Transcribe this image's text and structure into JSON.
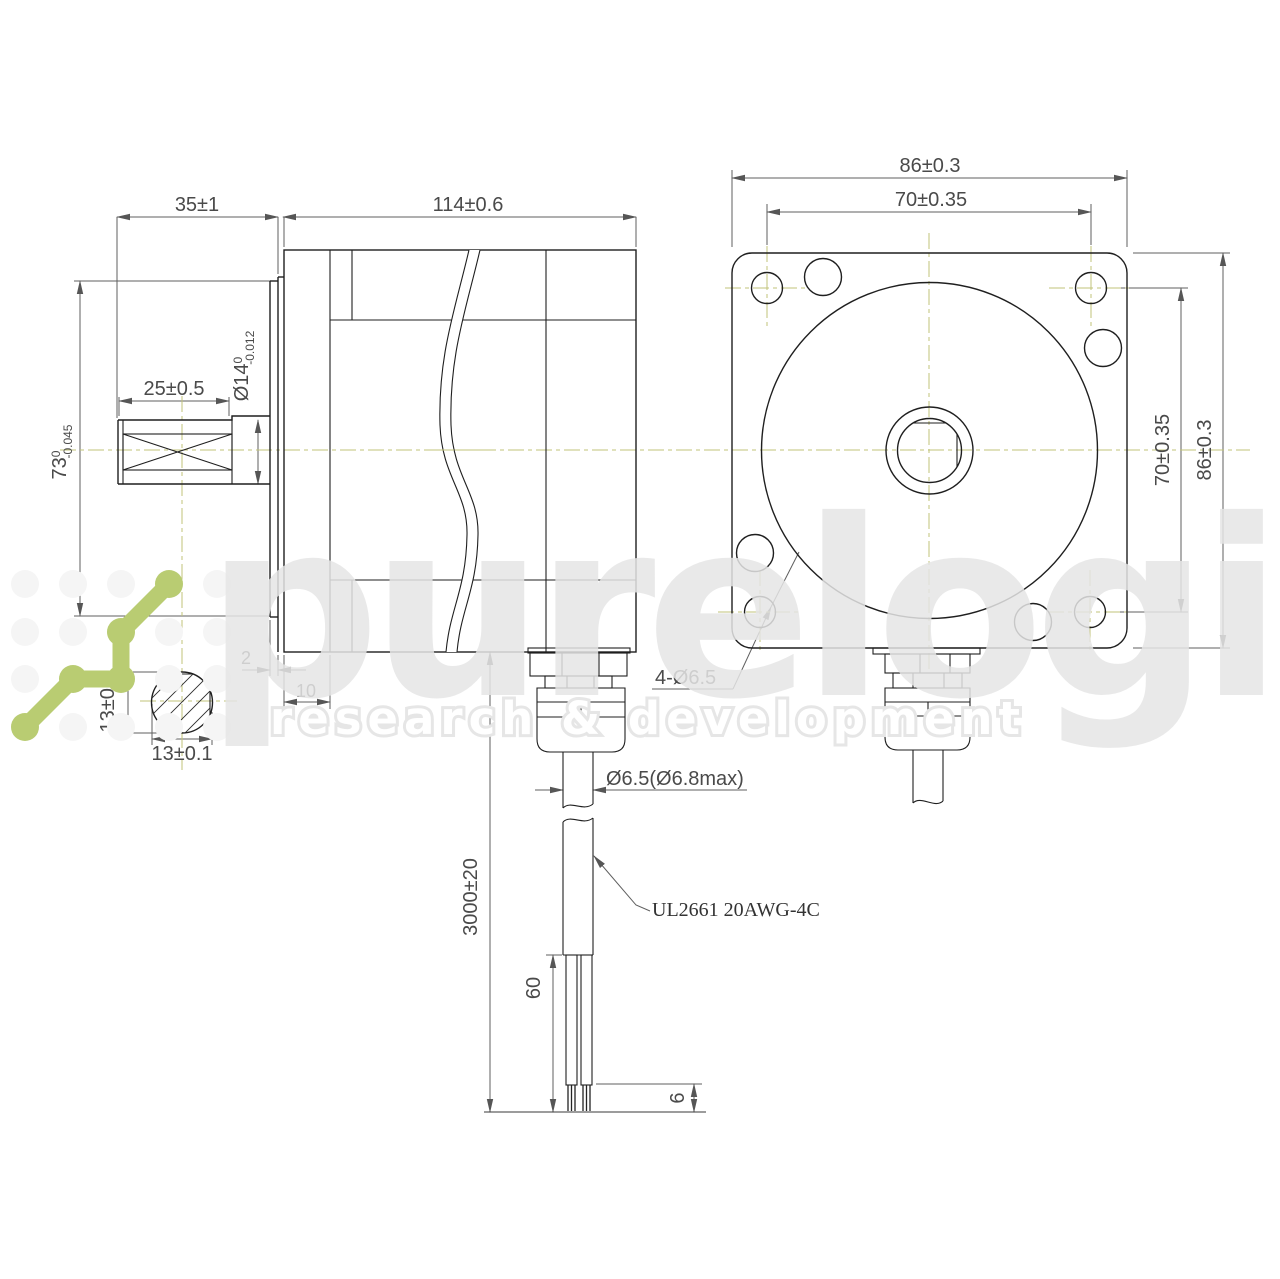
{
  "drawing": {
    "type": "stepper-motor dimensional drawing",
    "views": [
      "side-view",
      "front-view",
      "cable-detail",
      "shaft-cross-section"
    ]
  },
  "dims": {
    "shaft_ext": "35±1",
    "body_len": "114±0.6",
    "flat_len": "25±0.5",
    "shaft_d": "Ø14",
    "shaft_tol_top": "0",
    "shaft_tol_bot": "-0.012",
    "pilot_d": "73",
    "pilot_tol_top": "0",
    "pilot_tol_bot": "-0.045",
    "pilot_step": "2",
    "front_cover": "10",
    "af_vertical": "13±0.1",
    "af_horizontal": "13±0.1",
    "frame_w": "86±0.3",
    "bolt_w": "70±0.35",
    "bolt_h": "70±0.35",
    "frame_h": "86±0.3",
    "holes": "4-Ø6.5",
    "cable_d": "Ø6.5(Ø6.8max)",
    "cable_len": "3000±20",
    "leads_len": "60",
    "strip_len": "6",
    "wire_spec": "UL2661 20AWG-4C"
  },
  "watermark": {
    "brand": "purelogic",
    "tagline": "research & development"
  },
  "colors": {
    "object_line": "#1f1f1f",
    "dimension_line": "#5f5f5f",
    "centerline": "#c2c378",
    "logo_green": "#b9cc72",
    "watermark_grey": "#e7e7e7"
  }
}
